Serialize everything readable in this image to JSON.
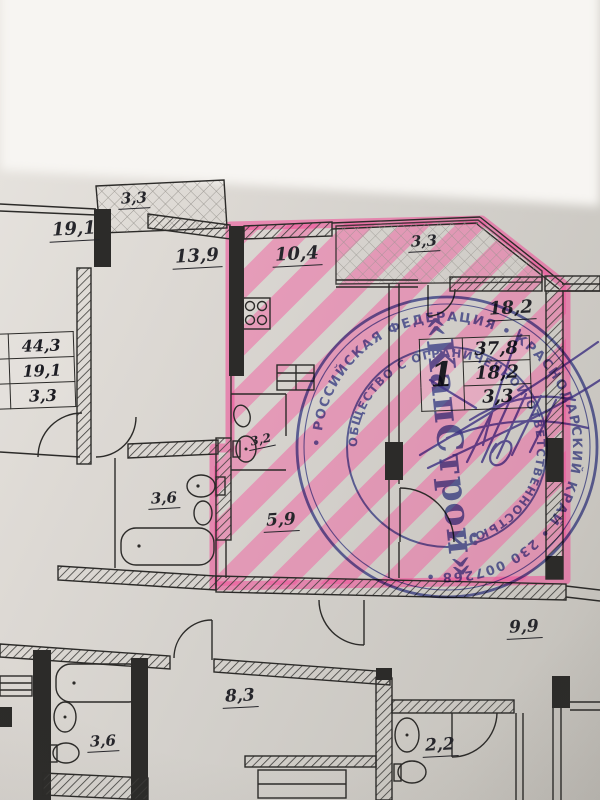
{
  "rooms": [
    {
      "id": "balcony-top-left",
      "area": "3,3"
    },
    {
      "id": "room-19-1",
      "area": "19,1"
    },
    {
      "id": "room-13-9",
      "area": "13,9"
    },
    {
      "id": "kitchen-10-4",
      "area": "10,4"
    },
    {
      "id": "balcony-top",
      "area": "3,3"
    },
    {
      "id": "room-18-2",
      "area": "18,2"
    },
    {
      "id": "bathroom-3-2",
      "area": "3,2"
    },
    {
      "id": "bathroom-3-6",
      "area": "3,6"
    },
    {
      "id": "hall-5-9",
      "area": "5,9"
    },
    {
      "id": "room-9-9",
      "area": "9,9"
    },
    {
      "id": "room-8-3",
      "area": "8,3"
    },
    {
      "id": "bathroom-3-6-bottom",
      "area": "3,6"
    },
    {
      "id": "bathroom-2-2",
      "area": "2,2"
    }
  ],
  "left_table": {
    "rows": [
      "44,3",
      "19,1",
      "3,3"
    ]
  },
  "apartment_table": {
    "rooms_count": "1",
    "total": "37,8",
    "living": "18,2",
    "balcony": "3,3"
  },
  "stamp": {
    "outer_text": "• РОССИЙСКАЯ ФЕДЕРАЦИЯ • КРАСНОДАРСКИЙ КРАЙ • 230 007268 •",
    "inner_text": "ОБЩЕСТВО С ОГРАНИЧЕННОЙ ОТВЕТСТВЕННОСТЬЮ",
    "center_text": "«КапСтрой»"
  },
  "colors": {
    "highlight_pink": "#f25d9e",
    "stamp_blue": "#4c52a8",
    "signature_violet": "#4c3da8",
    "plan_line": "#2c2b29"
  }
}
